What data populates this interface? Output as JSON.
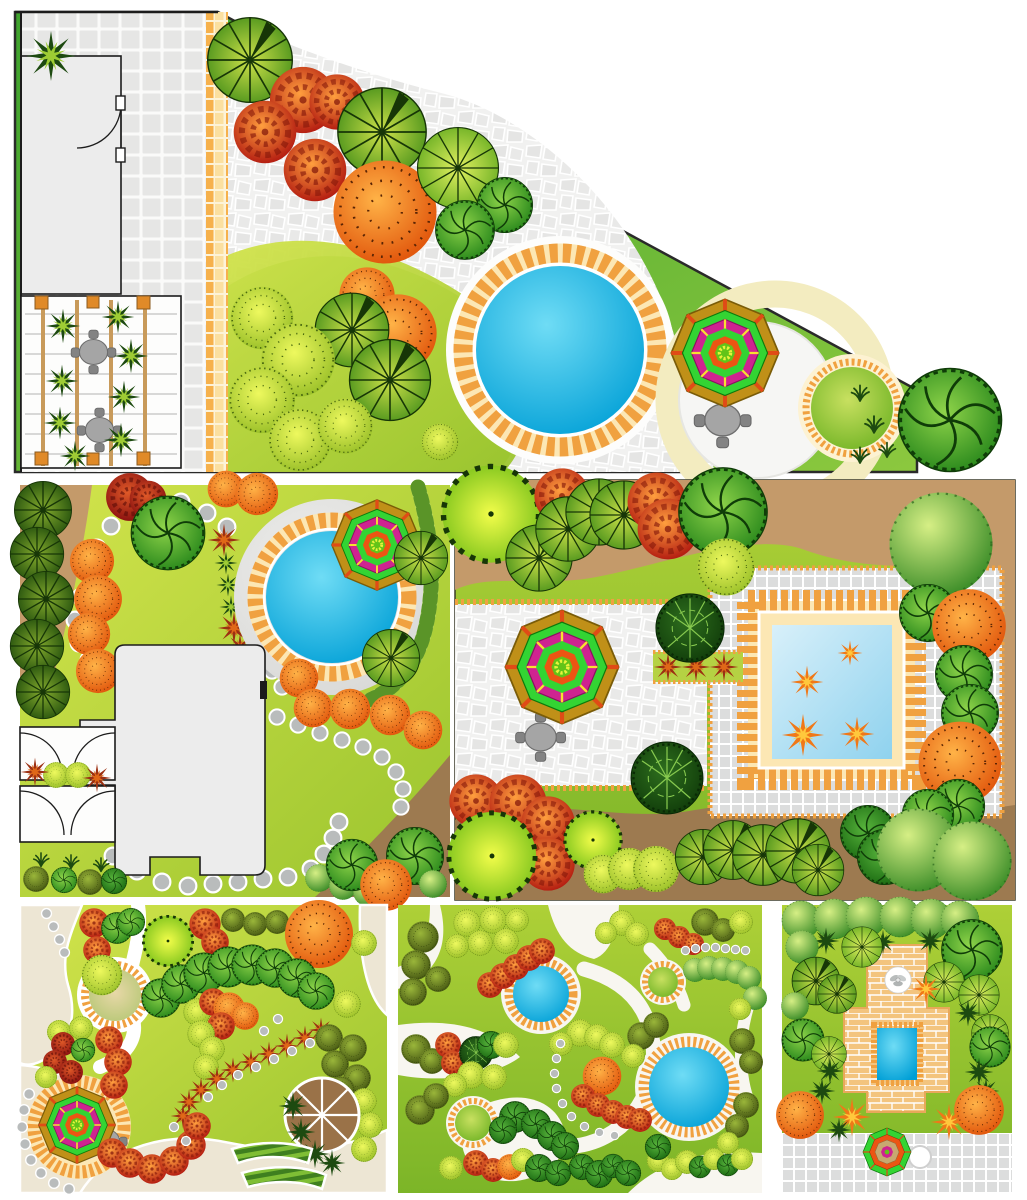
{
  "document": {
    "type": "landscape-design-plan-collection",
    "background": "#ffffff",
    "plan_count": 6
  },
  "palette": {
    "house-fill": "#ececec",
    "house-line": "#1c1c1c",
    "paving-bg": "#f2f2f1",
    "paving-tile": "#e4e4e3",
    "tile-orange": "#f0a140",
    "tile-cream": "#fce7b4",
    "pool-blue-hi": "#6fdcf5",
    "pool-blue-lo": "#009fd6",
    "poolsq-hi": "#d8f0fa",
    "poolsq-lo": "#8fd2ee",
    "deck-gray": "#d8d8d6",
    "cream-ring": "#f3ecc0",
    "lawn-hi": "#d3e44c",
    "lawn-lo": "#9ac42e",
    "lawn3-hi": "#aed037",
    "lawn3-lo": "#7cb528",
    "band-green-hi": "#8cc83e",
    "band-green-lo": "#3fa32e",
    "brown-1": "#c49a6a",
    "brown-2": "#9d7a50",
    "path-beige": "#ede6d4",
    "path-white": "#f8f6f0",
    "stone": "#b9bcbc",
    "trellis-beam": "#c89a5a",
    "trellis-post": "#e08a28",
    "table-gray": "#a5a5a5",
    "chair-gray": "#838383",
    "deck-wood": "#9a7248",
    "brick": "#f3c47e",
    "gray-tile": "#dcdddd",
    "rib-hi": "#cfe24a",
    "rib-lo": "#4e941c",
    "rib-line": "#173607",
    "rib2-hi": "#e2f060",
    "rib2-lo": "#6db024",
    "cone-hi": "#86ac2e",
    "cone-lo": "#27530e",
    "flw-hi": "#ff9f3e",
    "flw-lo": "#b51f12",
    "flw-line": "#7e1208",
    "flw2-hi": "#e05a28",
    "flw2-lo": "#8c1210",
    "swl-hi": "#8fd44a",
    "swl-lo": "#2e8c1e",
    "swl-line": "#0f3c08",
    "swl2-hi": "#58b43c",
    "swl2-lo": "#1e6e14",
    "org-hi": "#ffb347",
    "org-lo": "#e2590e",
    "speck-line": "#5a2404",
    "yel-hi": "#eef95e",
    "yel-lo": "#9dc22b",
    "crn-hi": "#f2fd4a",
    "crn-lo": "#7fc41c",
    "dkl-hi": "#2e6e1e",
    "dkl-lo": "#123f0b",
    "vein-green": "#86c84e",
    "ball-hi": "#d6ef85",
    "ball-lo": "#3f8f2a",
    "olv-hi": "#9ab63a",
    "olv-lo": "#4a5c14",
    "maple-red": "#9c3012",
    "maple-orange": "#e06818",
    "leaf-orange": "#f07818",
    "leaf-yellow": "#ffc83c",
    "palm-green": "#1d4a10",
    "fern-light": "#9ecc34",
    "hedge-hi": "#b7d96e",
    "hedge-lo": "#5a9428",
    "umb-gold": "#c09018",
    "umb-spoke": "#e04b16",
    "umb-green": "#33d433",
    "umb-magenta": "#cf2390",
    "umb-orange": "#ec5513",
    "umb-center": "#62c418",
    "umb-star": "#e8f23c"
  },
  "plans": [
    {
      "id": "triangular-courtyard-garden",
      "elements": [
        "house",
        "door-arc",
        "square-tile-patio",
        "pergola-with-seating",
        "patio-tables",
        "yellow-tile-path",
        "ornamental-trees",
        "shrub-bed",
        "round-swimming-pool",
        "tile-pool-surround",
        "parasol",
        "table-with-chairs",
        "cream-ring-terrace",
        "round-lawn-circle",
        "grass-tufts",
        "large-specimen-tree"
      ]
    },
    {
      "id": "lawn-garden-with-round-pool",
      "elements": [
        "house-footprint",
        "garage-door-bays",
        "round-pool-with-deck",
        "parasol",
        "stepping-stone-loop",
        "conifer-row",
        "orange-shrub-row",
        "maple-accent-line",
        "curved-hedge",
        "corner-planting-beds",
        "grass-tufts"
      ]
    },
    {
      "id": "walled-garden-with-square-pool",
      "elements": [
        "perimeter-tree-border",
        "crazy-paved-patio",
        "parasol",
        "table-with-chairs",
        "square-pool-with-floating-leaves",
        "tile-pool-frame",
        "grid-paving",
        "clipped-evergreen-trees",
        "maple-planter",
        "tile-edge-strips"
      ]
    },
    {
      "id": "winding-path-garden",
      "elements": [
        "beige-gravel-paths",
        "round-pond",
        "round-patio-with-parasol",
        "table-with-chairs",
        "stepping-stones",
        "tree-chains",
        "maple-chain",
        "wooden-deck-circle",
        "striped-planting-beds",
        "palm-tufts"
      ]
    },
    {
      "id": "two-pond-park-garden",
      "elements": [
        "white-path-network",
        "medium-pond",
        "large-scalloped-pond",
        "round-lawn-circles",
        "mixed-tree-clusters",
        "stepping-stone-chains"
      ]
    },
    {
      "id": "brick-terrace-garden",
      "elements": [
        "clipped-ball-tree-row",
        "brick-terrace",
        "fountain",
        "square-plunge-pool",
        "gray-tile-apron",
        "parasol",
        "round-side-table",
        "maple-accents",
        "palm-tufts"
      ]
    }
  ]
}
